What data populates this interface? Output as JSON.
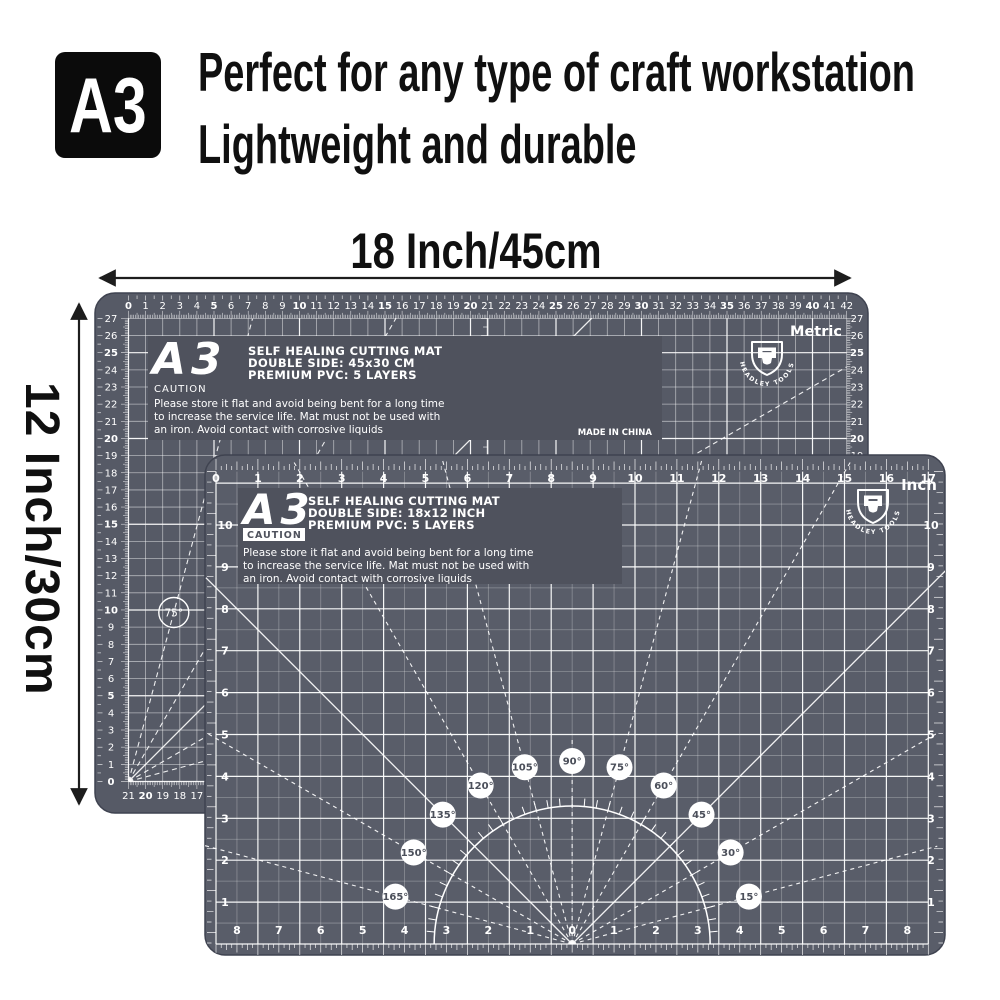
{
  "badge": {
    "label": "A3"
  },
  "headline": {
    "line1": "Perfect for any type of craft workstation",
    "line2": "Lightweight and durable"
  },
  "dimension_labels": {
    "width": "18 Inch/45cm",
    "height": "12 Inch/30cm"
  },
  "brand": {
    "name": "HEADLEY TOOLS"
  },
  "colors": {
    "background": "#ffffff",
    "mat_back": "#565a66",
    "mat_front": "#595d69",
    "mat_edge": "#3f4350",
    "panel": "#4f525d",
    "grid_minor": "rgba(255,255,255,0.30)",
    "grid_mid": "rgba(255,255,255,0.55)",
    "grid_major": "rgba(255,255,255,0.95)",
    "mat_text": "#ffffff",
    "circle_text": "#4b4f5a",
    "arrow": "#1d1d1d",
    "badge_bg": "#0b0b0b",
    "headline_text": "#101010"
  },
  "back_mat": {
    "side_label": "Metric",
    "header": {
      "size_code": "A3",
      "title": "SELF HEALING CUTTING MAT",
      "subtitle": "DOUBLE SIDE: 45x30 CM",
      "material": "PREMIUM PVC: 5 LAYERS",
      "caution": "CAUTION",
      "care_line1": "Please store it flat and avoid being bent for a long time",
      "care_line2": "to increase the service life. Mat must not be used with",
      "care_line3": "an iron. Avoid contact with corrosive liquids",
      "origin": "MADE IN CHINA"
    },
    "top_ruler": [
      "0",
      "1",
      "2",
      "3",
      "4",
      "5",
      "6",
      "7",
      "8",
      "9",
      "10",
      "11",
      "12",
      "13",
      "14",
      "15",
      "16",
      "17",
      "18",
      "19",
      "20",
      "21",
      "22",
      "23",
      "24",
      "25",
      "26",
      "27",
      "28",
      "29",
      "30",
      "31",
      "32",
      "33",
      "34",
      "35",
      "36",
      "37",
      "38",
      "39",
      "40",
      "41",
      "42"
    ],
    "side_ruler": [
      "27",
      "26",
      "25",
      "24",
      "23",
      "22",
      "21",
      "20",
      "19",
      "18",
      "17",
      "16",
      "15",
      "14",
      "13",
      "12",
      "11",
      "10",
      "9",
      "8",
      "7",
      "6",
      "5",
      "4",
      "3",
      "2",
      "1",
      "0"
    ],
    "bottom_ruler": [
      "0",
      "1",
      "2",
      "3",
      "4",
      "5",
      "6",
      "7",
      "8",
      "9",
      "10",
      "11",
      "12",
      "13",
      "14",
      "15",
      "16",
      "17",
      "18",
      "19",
      "20",
      "21"
    ],
    "angle_label": "75°"
  },
  "front_mat": {
    "side_label": "Inch",
    "header": {
      "size_code": "A3",
      "title": "SELF HEALING CUTTING MAT",
      "subtitle": "DOUBLE SIDE: 18x12 INCH",
      "material": "PREMIUM PVC: 5 LAYERS",
      "caution": "CAUTION",
      "care_line1": "Please store it flat and avoid being bent for a long time",
      "care_line2": "to increase the service life. Mat must not be used with",
      "care_line3": "an iron. Avoid contact with corrosive liquids"
    },
    "top_ruler": [
      "0",
      "1",
      "2",
      "3",
      "4",
      "5",
      "6",
      "7",
      "8",
      "9",
      "10",
      "11",
      "12",
      "13",
      "14",
      "15",
      "16",
      "17"
    ],
    "side_ruler": [
      "10",
      "9",
      "8",
      "7",
      "6",
      "5",
      "4",
      "3",
      "2",
      "1"
    ],
    "bottom_ruler": [
      "0",
      "1",
      "2",
      "3",
      "4",
      "5",
      "6",
      "7",
      "8"
    ],
    "angle_labels": [
      "15°",
      "30°",
      "45°",
      "60°",
      "75°",
      "90°",
      "105°",
      "120°",
      "135°",
      "150°",
      "165°"
    ]
  }
}
